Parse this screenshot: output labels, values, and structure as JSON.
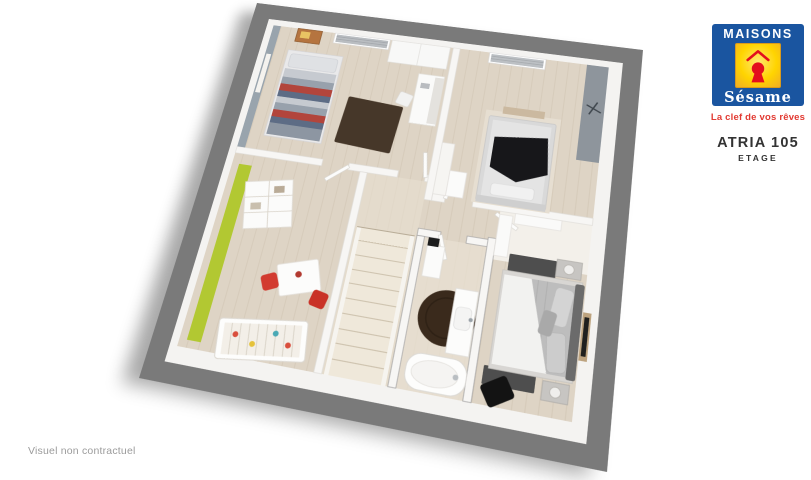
{
  "theme": {
    "logo-blue": "#1a55a0",
    "logo-yellow": "#ffd400",
    "logo-red": "#e30f1d",
    "tagline-red": "#e23a32",
    "title-dark": "#333333",
    "disclaimer-gray": "#9b9b9b",
    "wall-gray": "#7a7a7a",
    "floor-beige": "#ded4c5",
    "accent-green": "#b2c832",
    "chair-red": "#d23b30"
  },
  "brand": {
    "name_top": "MAISONS",
    "name_script": "Sésame",
    "tagline": "La clef de vos rêves",
    "keyhole_icon": "red-keyhole-with-roof"
  },
  "plan": {
    "title": "ATRIA 105",
    "subtitle": "ETAGE"
  },
  "footer": {
    "disclaimer": "Visuel non contractuel"
  }
}
